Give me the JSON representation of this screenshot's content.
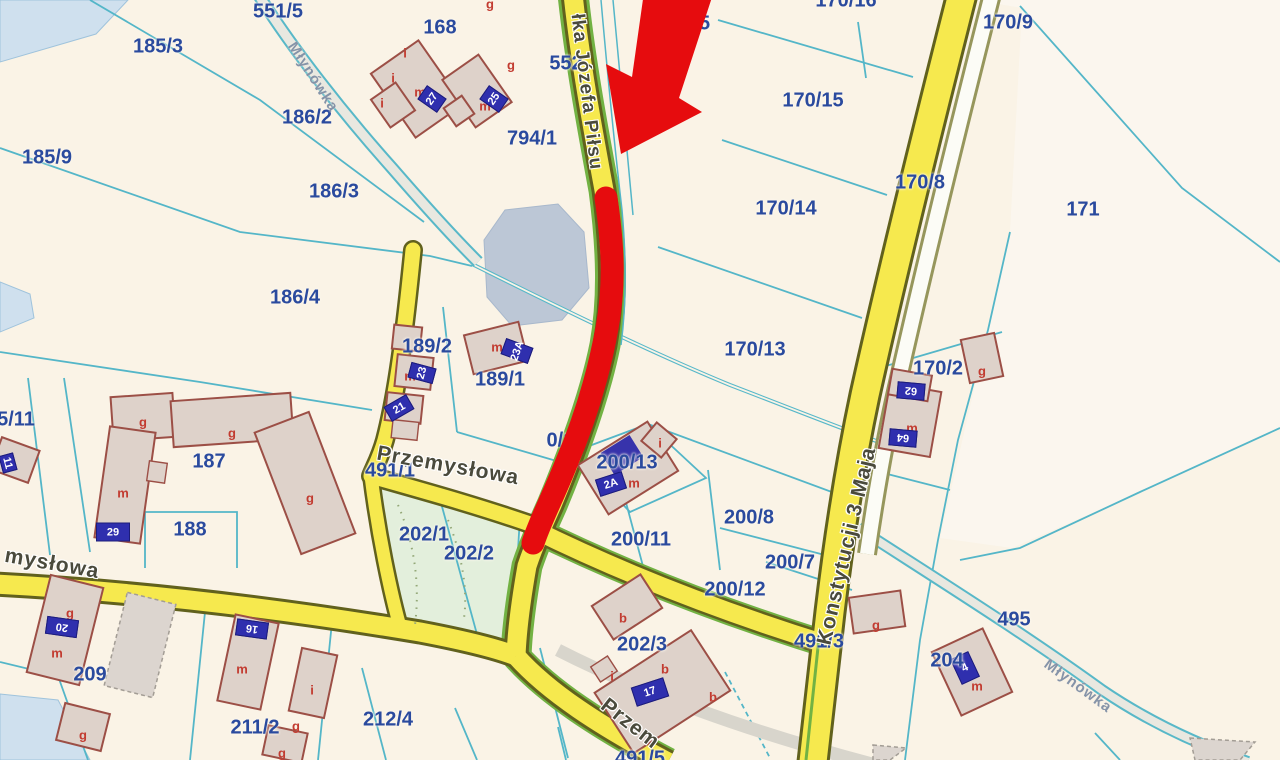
{
  "map": {
    "description": "Cadastral parcel map with red arrow annotation pointing to a red-highlighted road segment",
    "colors": {
      "background": "#faf3e6",
      "parcel_line": "#54b6c8",
      "parcel_label": "#2a4a9e",
      "road_fill": "#f6e94e",
      "road_casing": "#61611d",
      "trail_green": "#72b243",
      "water": "#cfe0ee",
      "pond": "#bcc7d6",
      "building_fill": "#ded2ca",
      "building_stroke": "#9c4f46",
      "address_plate": "#2f2fae",
      "annotation_red": "#e60c0e"
    },
    "annotation": {
      "arrow": "red-arrow pointing down-left at road",
      "route": "red highlighted road segment along Piłsudskiego street"
    },
    "parcel_labels": [
      {
        "text": "551/5",
        "x": 278,
        "y": 12
      },
      {
        "text": "185/3",
        "x": 158,
        "y": 47
      },
      {
        "text": "185/9",
        "x": 47,
        "y": 158
      },
      {
        "text": "186/2",
        "x": 307,
        "y": 118
      },
      {
        "text": "186/3",
        "x": 334,
        "y": 192
      },
      {
        "text": "186/4",
        "x": 295,
        "y": 298
      },
      {
        "text": "168",
        "x": 440,
        "y": 28
      },
      {
        "text": "552",
        "x": 566,
        "y": 64
      },
      {
        "text": "794/1",
        "x": 532,
        "y": 139
      },
      {
        "text": "15",
        "x": 699,
        "y": 24
      },
      {
        "text": "170/16",
        "x": 846,
        "y": 1
      },
      {
        "text": "170/9",
        "x": 1008,
        "y": 23
      },
      {
        "text": "170/15",
        "x": 813,
        "y": 101
      },
      {
        "text": "170/14",
        "x": 786,
        "y": 209
      },
      {
        "text": "170/8",
        "x": 920,
        "y": 183
      },
      {
        "text": "171",
        "x": 1083,
        "y": 210
      },
      {
        "text": "170/13",
        "x": 755,
        "y": 350
      },
      {
        "text": "170/2",
        "x": 938,
        "y": 369
      },
      {
        "text": "189/2",
        "x": 427,
        "y": 347
      },
      {
        "text": "189/1",
        "x": 500,
        "y": 380
      },
      {
        "text": "187",
        "x": 209,
        "y": 462
      },
      {
        "text": "188",
        "x": 190,
        "y": 530
      },
      {
        "text": "5/11",
        "x": 16,
        "y": 420
      },
      {
        "text": "200/13",
        "x": 627,
        "y": 463
      },
      {
        "text": "0/10",
        "x": 566,
        "y": 441
      },
      {
        "text": "200/11",
        "x": 641,
        "y": 540
      },
      {
        "text": "200/8",
        "x": 749,
        "y": 518
      },
      {
        "text": "200/7",
        "x": 790,
        "y": 563
      },
      {
        "text": "200/12",
        "x": 735,
        "y": 590
      },
      {
        "text": "202/1",
        "x": 424,
        "y": 535
      },
      {
        "text": "202/2",
        "x": 469,
        "y": 554
      },
      {
        "text": "202/3",
        "x": 642,
        "y": 645
      },
      {
        "text": "491/1",
        "x": 390,
        "y": 471
      },
      {
        "text": "491/3",
        "x": 819,
        "y": 642
      },
      {
        "text": "495",
        "x": 1014,
        "y": 620
      },
      {
        "text": "204",
        "x": 947,
        "y": 661
      },
      {
        "text": "209",
        "x": 90,
        "y": 675
      },
      {
        "text": "211/2",
        "x": 255,
        "y": 728
      },
      {
        "text": "212/4",
        "x": 388,
        "y": 720
      },
      {
        "text": "491/5",
        "x": 640,
        "y": 759
      }
    ],
    "street_labels": [
      {
        "text": "łka Józefa Piłsu",
        "x": 586,
        "y": 92,
        "rot": 83,
        "kind": "road",
        "size": 19
      },
      {
        "text": "Przemysłowa",
        "x": 448,
        "y": 466,
        "rot": 10,
        "kind": "road",
        "size": 21
      },
      {
        "text": "mysłowa",
        "x": 52,
        "y": 564,
        "rot": 10,
        "kind": "road",
        "size": 21
      },
      {
        "text": "Przem",
        "x": 630,
        "y": 724,
        "rot": 38,
        "kind": "road",
        "size": 21
      },
      {
        "text": "Konstytucji 3 Maja",
        "x": 847,
        "y": 546,
        "rot": -77,
        "kind": "road",
        "size": 21
      },
      {
        "text": "Młynówka",
        "x": 313,
        "y": 77,
        "rot": 57,
        "kind": "water",
        "size": 15
      },
      {
        "text": "Młynówka",
        "x": 1078,
        "y": 686,
        "rot": 36,
        "kind": "water",
        "size": 15
      }
    ],
    "building_letters": [
      {
        "text": "i",
        "x": 405,
        "y": 53
      },
      {
        "text": "i",
        "x": 393,
        "y": 78
      },
      {
        "text": "i",
        "x": 382,
        "y": 103
      },
      {
        "text": "m",
        "x": 420,
        "y": 92
      },
      {
        "text": "g",
        "x": 511,
        "y": 65
      },
      {
        "text": "m",
        "x": 485,
        "y": 106
      },
      {
        "text": "g",
        "x": 490,
        "y": 4
      },
      {
        "text": "m",
        "x": 410,
        "y": 376
      },
      {
        "text": "m",
        "x": 497,
        "y": 347
      },
      {
        "text": "m",
        "x": 634,
        "y": 483
      },
      {
        "text": "i",
        "x": 660,
        "y": 443
      },
      {
        "text": "g",
        "x": 143,
        "y": 422
      },
      {
        "text": "g",
        "x": 232,
        "y": 433
      },
      {
        "text": "m",
        "x": 123,
        "y": 493
      },
      {
        "text": "g",
        "x": 310,
        "y": 498
      },
      {
        "text": "g",
        "x": 70,
        "y": 613
      },
      {
        "text": "m",
        "x": 57,
        "y": 653
      },
      {
        "text": "g",
        "x": 83,
        "y": 735
      },
      {
        "text": "m",
        "x": 242,
        "y": 669
      },
      {
        "text": "i",
        "x": 312,
        "y": 690
      },
      {
        "text": "g",
        "x": 296,
        "y": 726
      },
      {
        "text": "g",
        "x": 282,
        "y": 753
      },
      {
        "text": "b",
        "x": 623,
        "y": 618
      },
      {
        "text": "b",
        "x": 665,
        "y": 669
      },
      {
        "text": "b",
        "x": 713,
        "y": 697
      },
      {
        "text": "i",
        "x": 612,
        "y": 676
      },
      {
        "text": "m",
        "x": 912,
        "y": 428
      },
      {
        "text": "g",
        "x": 982,
        "y": 371
      },
      {
        "text": "g",
        "x": 876,
        "y": 625
      },
      {
        "text": "m",
        "x": 977,
        "y": 686
      }
    ],
    "address_plates": [
      {
        "text": "27",
        "x": 432,
        "y": 99,
        "w": 15,
        "h": 22,
        "rot": -55
      },
      {
        "text": "25",
        "x": 494,
        "y": 99,
        "w": 15,
        "h": 22,
        "rot": -55
      },
      {
        "text": "23A",
        "x": 517,
        "y": 351,
        "w": 15,
        "h": 27,
        "rot": -70
      },
      {
        "text": "23",
        "x": 422,
        "y": 373,
        "w": 14,
        "h": 24,
        "rot": -75
      },
      {
        "text": "21",
        "x": 399,
        "y": 408,
        "w": 24,
        "h": 15,
        "rot": -30
      },
      {
        "text": "2A",
        "x": 611,
        "y": 484,
        "w": 26,
        "h": 16,
        "rot": -18
      },
      {
        "text": "29",
        "x": 113,
        "y": 532,
        "w": 32,
        "h": 17,
        "rot": 0
      },
      {
        "text": "20",
        "x": 62,
        "y": 627,
        "w": 30,
        "h": 16,
        "rot": 188
      },
      {
        "text": "16",
        "x": 252,
        "y": 629,
        "w": 30,
        "h": 15,
        "rot": 188
      },
      {
        "text": "17",
        "x": 650,
        "y": 692,
        "w": 32,
        "h": 18,
        "rot": -18
      },
      {
        "text": "62",
        "x": 911,
        "y": 391,
        "w": 26,
        "h": 15,
        "rot": 185
      },
      {
        "text": "64",
        "x": 903,
        "y": 438,
        "w": 26,
        "h": 15,
        "rot": 185
      },
      {
        "text": "11",
        "x": 8,
        "y": 463,
        "w": 16,
        "h": 13,
        "rot": 75
      },
      {
        "text": "4",
        "x": 965,
        "y": 668,
        "w": 18,
        "h": 26,
        "rot": -25
      }
    ]
  }
}
